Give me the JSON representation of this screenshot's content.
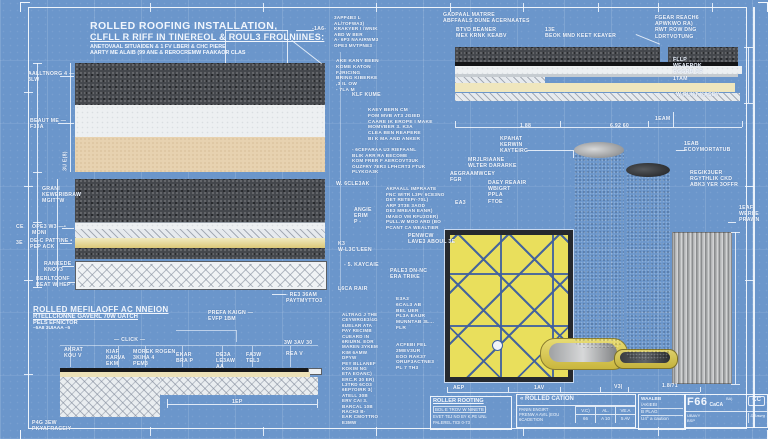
{
  "colors": {
    "paper_blue": "#6b96cb",
    "ink_white": "#f1f6fd",
    "asphalt_dark": "#44474c",
    "underlay_tan": "#e7d2b0",
    "adhesive_yellow": "#dcc878",
    "mat_yellow": "#e9df5c",
    "mat_line_blue": "#3e5fa0",
    "frame_white": "#fafcff"
  },
  "header": {
    "title1": "ROLLED ROOFING INSTALLATION,",
    "title2": "CLFLL R RIFF IN TINEREOL & ROUL3 FROLNIINES:",
    "sub1": "ANETOVAAL SITUAIDEN & 1 FV LBERI & CHC PIERE",
    "sub2": "AARTY ME ALAIB (99 ANE & REROCREMW FAAKAOR CLAS"
  },
  "section2": {
    "title1": "ROLLED MEFILAOFF AC NNEION",
    "title2": "RTELLCIONNE GAVERL 70W UATCH",
    "title3": "PELS EFNICTOR",
    "title4": "–5A8 3UIAAA –5"
  },
  "titleblock": {
    "box1": {
      "l1": "ROLLER ROOTING",
      "l2": "BOL E TROV W NINETB",
      "l3": "EVET TEJ NO BY K.PE UNL",
      "l4": "PALEREL TIDI 0-73"
    },
    "box2": {
      "header": "« ROLLED CATION",
      "sub": "UA.",
      "r1": "PANIN ENGIRT",
      "r2": "PRENW A AVIL (EOU",
      "r3": "6CADETION",
      "cols": [
        "V.C)",
        "AL.",
        "VE.A"
      ],
      "vals": [
        "66",
        "A 10",
        "5 AV"
      ]
    },
    "box3": {
      "l1": "WAALBB",
      "l2": "/AKIEBI",
      "l3": "B PLAG",
      "l4": "U4° a caution"
    },
    "box4": {
      "big": "F66",
      "sub": "CaCA",
      "sup": "BA)",
      "cert": "CC",
      "l1": "UBAVY",
      "l2": "BSP",
      "l3": "DRawrg"
    }
  },
  "annotations": [
    {
      "t": "AALLTNORG 4 —\n3LW",
      "x": 28,
      "y": 71
    },
    {
      "t": "BEAUT ME —\nF33A",
      "x": 30,
      "y": 118
    },
    {
      "t": "3U E(8)",
      "x": 56,
      "y": 158,
      "r": -90
    },
    {
      "t": "GRANI\nKEWERIBRAW\nMGITTW",
      "x": 42,
      "y": 186
    },
    {
      "t": "CE",
      "x": 16,
      "y": 224
    },
    {
      "t": "OPE3 W3 —•\nMONI",
      "x": 32,
      "y": 224
    },
    {
      "t": "3E",
      "x": 16,
      "y": 240
    },
    {
      "t": "DE-C PATTINE •\nPEP ACK",
      "x": 30,
      "y": 238
    },
    {
      "t": "RANKEDE\nKNOV3",
      "x": 44,
      "y": 261
    },
    {
      "t": "BERLTCONF\nBEAT W HEP -",
      "x": 36,
      "y": 276
    },
    {
      "t": "- RE3 36AM\nPAYTMYTTO3",
      "x": 286,
      "y": 292
    },
    {
      "t": "-1A6-",
      "x": 312,
      "y": 26
    },
    {
      "t": "3APP4B3 L\nAL/7OFWA3)\nKRAKYER I /WNIK\nABD W BER\nA- 6P3 NAAIRWM3\nOPE3 MVTPNE3",
      "x": 334,
      "y": 15,
      "fs": 4.6
    },
    {
      "t": "AKE KANY BEEN\nKOME KATON\nFJRICING\nBRING KIBERKE\n,3 IL OW\n- 7LA M",
      "x": 336,
      "y": 59,
      "fs": 4.8
    },
    {
      "t": "KLF KUME",
      "x": 352,
      "y": 92
    },
    {
      "t": "KAEY BERN CM\nFOM MVB AT3 JGIED\nCAARE IK EROPE I MAKE\nMOMVBER 3. K3A\nCLEA BEN REAPERE\nBI K MA AND ANKER",
      "x": 368,
      "y": 108,
      "fs": 4.8
    },
    {
      "t": "- 6CEFARAA U3 RIEFAANL\nBLIK ARR RA BECOME\nKOM FRER F AERCOVT3UK\nOUZFRY 7ER3 LPHCRT3 FTUK\nPLYKOA3K",
      "x": 352,
      "y": 147,
      "fs": 4.6
    },
    {
      "t": "W. 6CLE3AK",
      "x": 336,
      "y": 181
    },
    {
      "t": "AKPAALL IMPRAATE\nFNC WITR L3Pr 6CE3NO\nDET RETEPr-70L)\nARP 3T3E 3AOD\nDE3 MREAN EANR)\nIMAEO VM RFU3OER)\nPULL.W MOO ARD (BO\nPCANT CA WEALTIER",
      "x": 386,
      "y": 186,
      "fs": 4.6
    },
    {
      "t": "ANGIE\nERIM\nP -",
      "x": 354,
      "y": 207
    },
    {
      "t": "K3\nW-L3C'LEEN",
      "x": 338,
      "y": 241
    },
    {
      "t": "PENWCW\nLAVE3 ABOUL   3E",
      "x": 408,
      "y": 233
    },
    {
      "t": "- 5. KAYCAIE",
      "x": 344,
      "y": 262
    },
    {
      "t": "PALE3 DN-NC\nERA TRIKE",
      "x": 390,
      "y": 268
    },
    {
      "t": "L6CA RAIR",
      "x": 338,
      "y": 286
    },
    {
      "t": "E3A3\n6CAL3 AB\nBEL UER\nPL3A EAUR\nMUNNTAB 3L...\nFLR",
      "x": 396,
      "y": 297,
      "fs": 4.8
    },
    {
      "t": "ALTRAG J THE\nCEYWRGE3/4G\n6UELAR ATA\nPAY RECIMB\nCUEARD IN\n6RIURN. EOR\nMAREN 3YKEM\nKIM 6AMW\nDPYW\nPEY BLLANEF\nKOKIM NG\nETA EOANC)\nERC.R 30 ER)\nL3TRD 6CO3\n6EP7OIRR 3(\nATELL 30B\nERV CAI 3.\nBARCAL 10B\nRACH3 B-\nEAR CMOTTRO\nE3MW",
      "x": 342,
      "y": 312,
      "fs": 4.5
    },
    {
      "t": "ACFEBI FEL\n2MEV3UR\nEOO RAK37\nORUF3ACTNE3\nPL 7 TH3",
      "x": 396,
      "y": 343,
      "fs": 4.8
    },
    {
      "t": "GADPAAL MATRRE\nABFFAALS DUNE ACERNAATES",
      "x": 443,
      "y": 12
    },
    {
      "t": "BTVD BEANER\nMEX KRNK  KEABV",
      "x": 456,
      "y": 27
    },
    {
      "t": "13E\nBEOK MND KEET KEAYER",
      "x": 545,
      "y": 27
    },
    {
      "t": "FGEAR REACH6\nAPWKWO RA)\nRWT ROW DNG\nLDRTVOTUNG",
      "x": 655,
      "y": 15
    },
    {
      "t": "FLLP\nWEAEROK\nRGGRB CP\n1TAM",
      "x": 673,
      "y": 57
    },
    {
      "t": "W-RUKT KASEY",
      "x": 676,
      "y": 92
    },
    {
      "t": "1.88",
      "x": 520,
      "y": 123
    },
    {
      "t": "6.92  60",
      "x": 610,
      "y": 123
    },
    {
      "t": "1EAM",
      "x": 655,
      "y": 116
    },
    {
      "t": "1EAB\nECOYMORTATUB",
      "x": 684,
      "y": 141
    },
    {
      "t": "KPAHAT\nKERWIN\nKAYTEIRG",
      "x": 500,
      "y": 136
    },
    {
      "t": "MRJLRIAANE\nWLTER DARARKE",
      "x": 468,
      "y": 157
    },
    {
      "t": "AEGRAAMWCEY\nFGR",
      "x": 450,
      "y": 171
    },
    {
      "t": "DAEY REAAIR\nWBIGRT\nPPLA\nFTOE",
      "x": 488,
      "y": 180
    },
    {
      "t": "EA3",
      "x": 455,
      "y": 200
    },
    {
      "t": "REGIK3UER\nRGYTHLIK CKD\nABK3 YER 3OFFR",
      "x": 690,
      "y": 170
    },
    {
      "t": "1EAF\nWERLE\nPRAWN",
      "x": 739,
      "y": 205
    },
    {
      "t": "AEP",
      "x": 453,
      "y": 385
    },
    {
      "t": "1AV",
      "x": 534,
      "y": 385
    },
    {
      "t": "V3|",
      "x": 614,
      "y": 384
    },
    {
      "t": "1.8/71",
      "x": 662,
      "y": 383
    },
    {
      "t": "PREFA KAIGN —\nEVFP 1BM",
      "x": 208,
      "y": 310
    },
    {
      "t": "— CLICK —",
      "x": 114,
      "y": 337
    },
    {
      "t": "AKRAT\nKOU V",
      "x": 64,
      "y": 347
    },
    {
      "t": "KIAF\nKARVA\nEKM",
      "x": 106,
      "y": 349
    },
    {
      "t": "MOREK ROGEN\n3KIHA 4\nPEM3",
      "x": 133,
      "y": 349
    },
    {
      "t": "EKAR\nBRA P",
      "x": 176,
      "y": 352
    },
    {
      "t": "DE3A\nLE3AW\nAA",
      "x": 216,
      "y": 352
    },
    {
      "t": "FA3W\nTEL3",
      "x": 246,
      "y": 352
    },
    {
      "t": "REA V",
      "x": 286,
      "y": 351
    },
    {
      "t": "3W  3AV  30",
      "x": 284,
      "y": 340
    },
    {
      "t": "1EP",
      "x": 232,
      "y": 399
    },
    {
      "t": "P4G 3EW\nPKYAFRACEIY",
      "x": 32,
      "y": 420
    }
  ]
}
